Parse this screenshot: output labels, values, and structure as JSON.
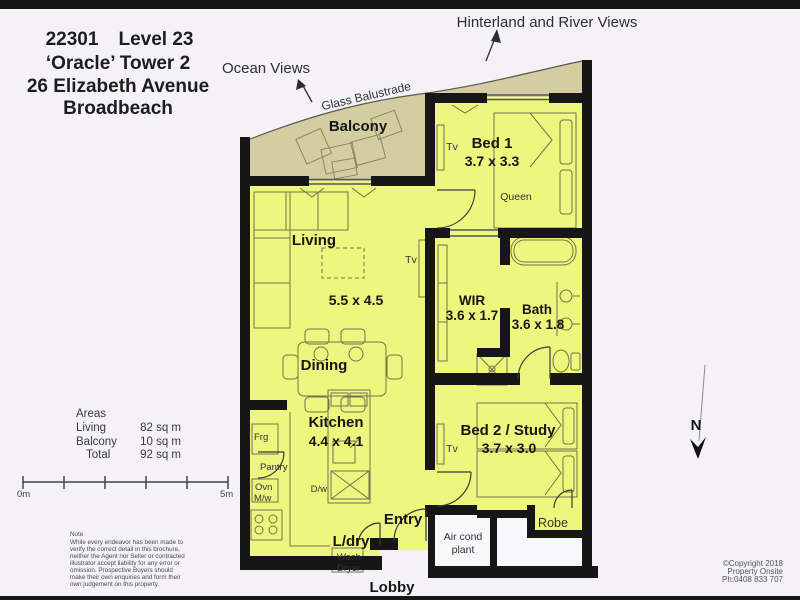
{
  "title_block": {
    "unit": "22301",
    "level": "Level 23",
    "building": "‘Oracle’ Tower 2",
    "street": "26 Elizabeth Avenue",
    "suburb": "Broadbeach"
  },
  "view_labels": {
    "hinterland": "Hinterland and River Views",
    "ocean": "Ocean Views",
    "balustrade": "Glass Balustrade"
  },
  "rooms": {
    "balcony": {
      "name": "Balcony"
    },
    "living": {
      "name": "Living",
      "dims": "5.5 x 4.5"
    },
    "dining": {
      "name": "Dining"
    },
    "kitchen": {
      "name": "Kitchen",
      "dims": "4.4 x 4.1"
    },
    "bed1": {
      "name": "Bed 1",
      "dims": "3.7 x 3.3",
      "bed": "Queen"
    },
    "wir": {
      "name": "WIR",
      "dims": "3.6 x 1.7"
    },
    "bath": {
      "name": "Bath",
      "dims": "3.6 x 1.8"
    },
    "bed2": {
      "name": "Bed 2 / Study",
      "dims": "3.7 x 3.0"
    },
    "entry": {
      "name": "Entry"
    },
    "laundry": {
      "name": "L/dry"
    },
    "lobby": {
      "name": "Lobby"
    },
    "robe": {
      "name": "Robe"
    },
    "aircond": {
      "line1": "Air cond",
      "line2": "plant"
    }
  },
  "fixtures": {
    "tv": "Tv",
    "fridge": "Frg",
    "pantry": "Pantry",
    "oven": "Ovn",
    "microwave": "M/w",
    "dishwasher": "D/w",
    "washer": "Wash",
    "dryer": "Dryer"
  },
  "areas": {
    "title": "Areas",
    "living_label": "Living",
    "living_value": "82 sq m",
    "balcony_label": "Balcony",
    "balcony_value": "10 sq m",
    "total_label": "Total",
    "total_value": "92 sq m"
  },
  "scale_bar": {
    "start_label": "0m",
    "end_label": "5m"
  },
  "compass": {
    "north_label": "N"
  },
  "note": {
    "title": "Note",
    "lines": [
      "While every endeavor has been made to",
      "verify the correct detail in this brochure,",
      "neither the Agent nor Seller or contracted",
      "illustrator accept liability for any error or",
      "omission. Prospective Buyers should",
      "make their own enquiries and form their",
      "own judgement on this property."
    ]
  },
  "copyright": {
    "line1": "©Copyright 2018",
    "line2": "Property Onsite",
    "line3": "Ph:0408 833 707"
  },
  "colors": {
    "interior": "#EDF67D",
    "balcony": "#D3CDA1",
    "wall": "#161616",
    "background": "#F4F2F6"
  }
}
